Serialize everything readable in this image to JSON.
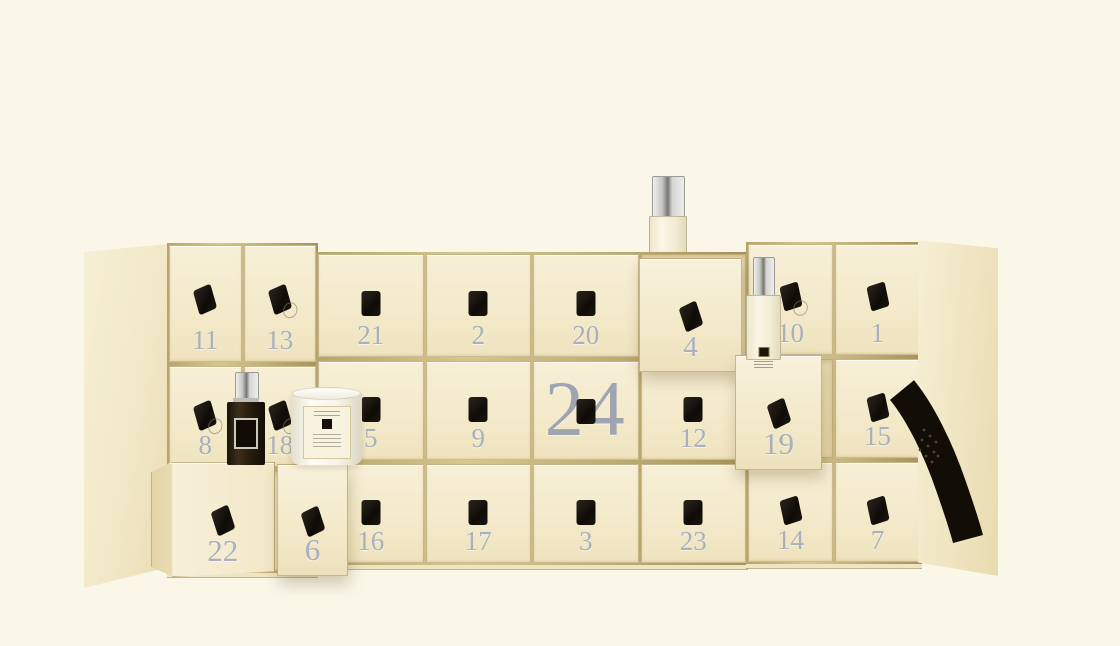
{
  "scene": {
    "subject": "advent calendar box with 24 numbered drawers",
    "total_drawers": 24
  },
  "calendar": {
    "wings": [
      {
        "id": "left",
        "columns": 2,
        "rows": [
          [
            "11",
            "13"
          ],
          [
            "8",
            "18"
          ],
          [
            "22",
            "6"
          ]
        ]
      },
      {
        "id": "center",
        "columns": 4,
        "rows": [
          [
            "21",
            "2",
            "20",
            "4"
          ],
          [
            "5",
            "9",
            "24",
            "12"
          ],
          [
            "16",
            "17",
            "3",
            "23"
          ]
        ]
      },
      {
        "id": "right",
        "columns": 2,
        "rows": [
          [
            "10",
            "1"
          ],
          [
            "19",
            "15"
          ],
          [
            "14",
            "7"
          ]
        ]
      }
    ],
    "pulled_drawers": [
      "22",
      "6",
      "4",
      "19"
    ],
    "feature_drawer": "24"
  },
  "products": [
    {
      "id": "cologne-bottle-on-box-top",
      "type": "cologne-bottle",
      "variant": "clear-glass-silver-cap"
    },
    {
      "id": "cologne-bottle-front",
      "type": "cologne-bottle",
      "variant": "clear-glass-silver-cap"
    },
    {
      "id": "dark-cologne-bottle",
      "type": "cologne-bottle",
      "variant": "dark-glass-silver-cap"
    },
    {
      "id": "travel-candle",
      "type": "candle",
      "variant": "white-glass-cream-label"
    },
    {
      "id": "black-ribbon",
      "type": "ribbon",
      "variant": "black"
    }
  ],
  "colors": {
    "background": "#FAF7E9",
    "box_cream": "#F4EACB",
    "gold_trim": "#A6935A",
    "number_silver": "#A8B0BD",
    "knob_black": "#0F0C08",
    "ribbon_black": "#120D07",
    "cap_silver": "#C4C4C2",
    "candle_white": "#FDFCF6",
    "dark_bottle": "#2A1E0F"
  }
}
